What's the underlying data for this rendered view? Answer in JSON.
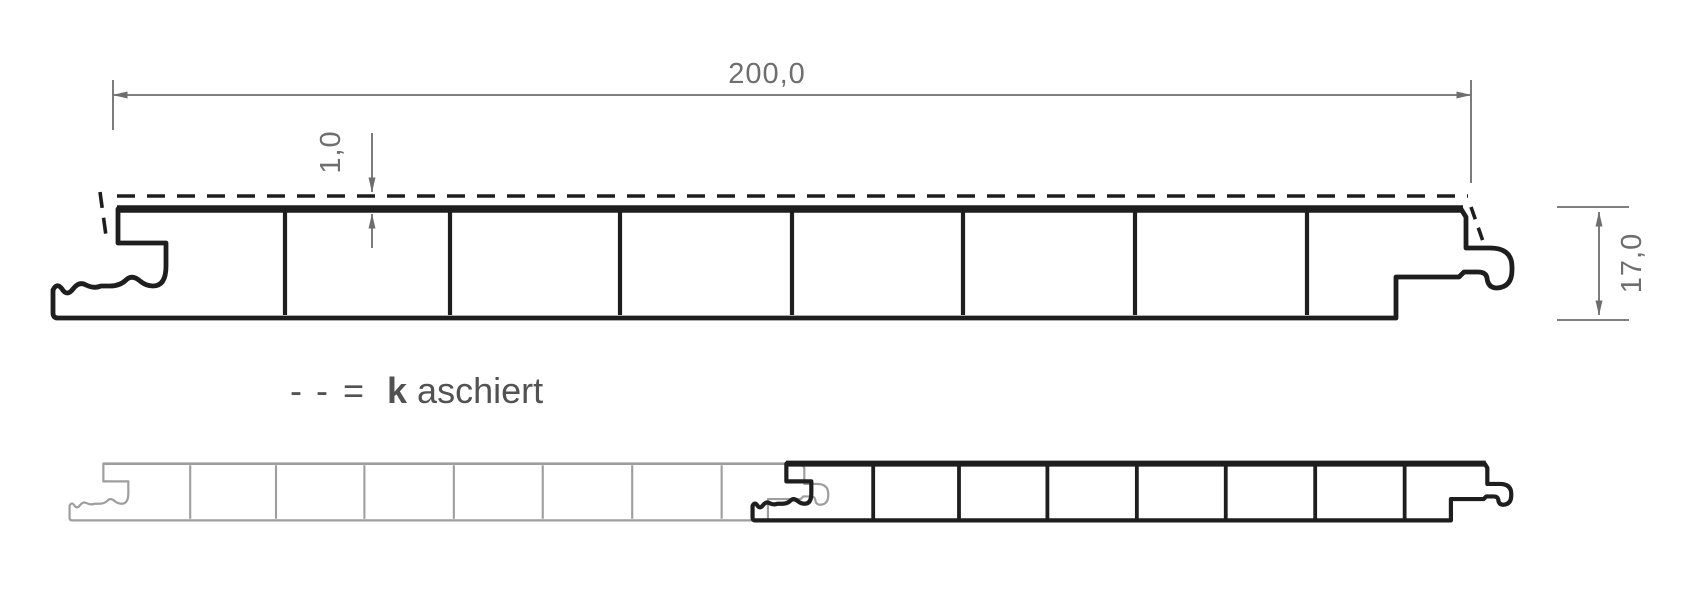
{
  "dims": {
    "width": "200,0",
    "cover": "1,0",
    "height": "17,0"
  },
  "legend": {
    "dash1": "-",
    "dash2": "-",
    "equals": "=",
    "bold": "k",
    "rest": "aschiert"
  },
  "profile": {
    "chamber_count": 8,
    "width_mm": 200.0,
    "height_mm": 17.0,
    "cover_thickness_mm": 1.0,
    "dashed_line_meaning": "kaschiert"
  },
  "colors": {
    "outline": "#1e1e1e",
    "mating_profile_gray": "#9e9e9e",
    "dimension_lines": "#6e6e6e",
    "legend_text": "#525252",
    "background": "#ffffff"
  }
}
